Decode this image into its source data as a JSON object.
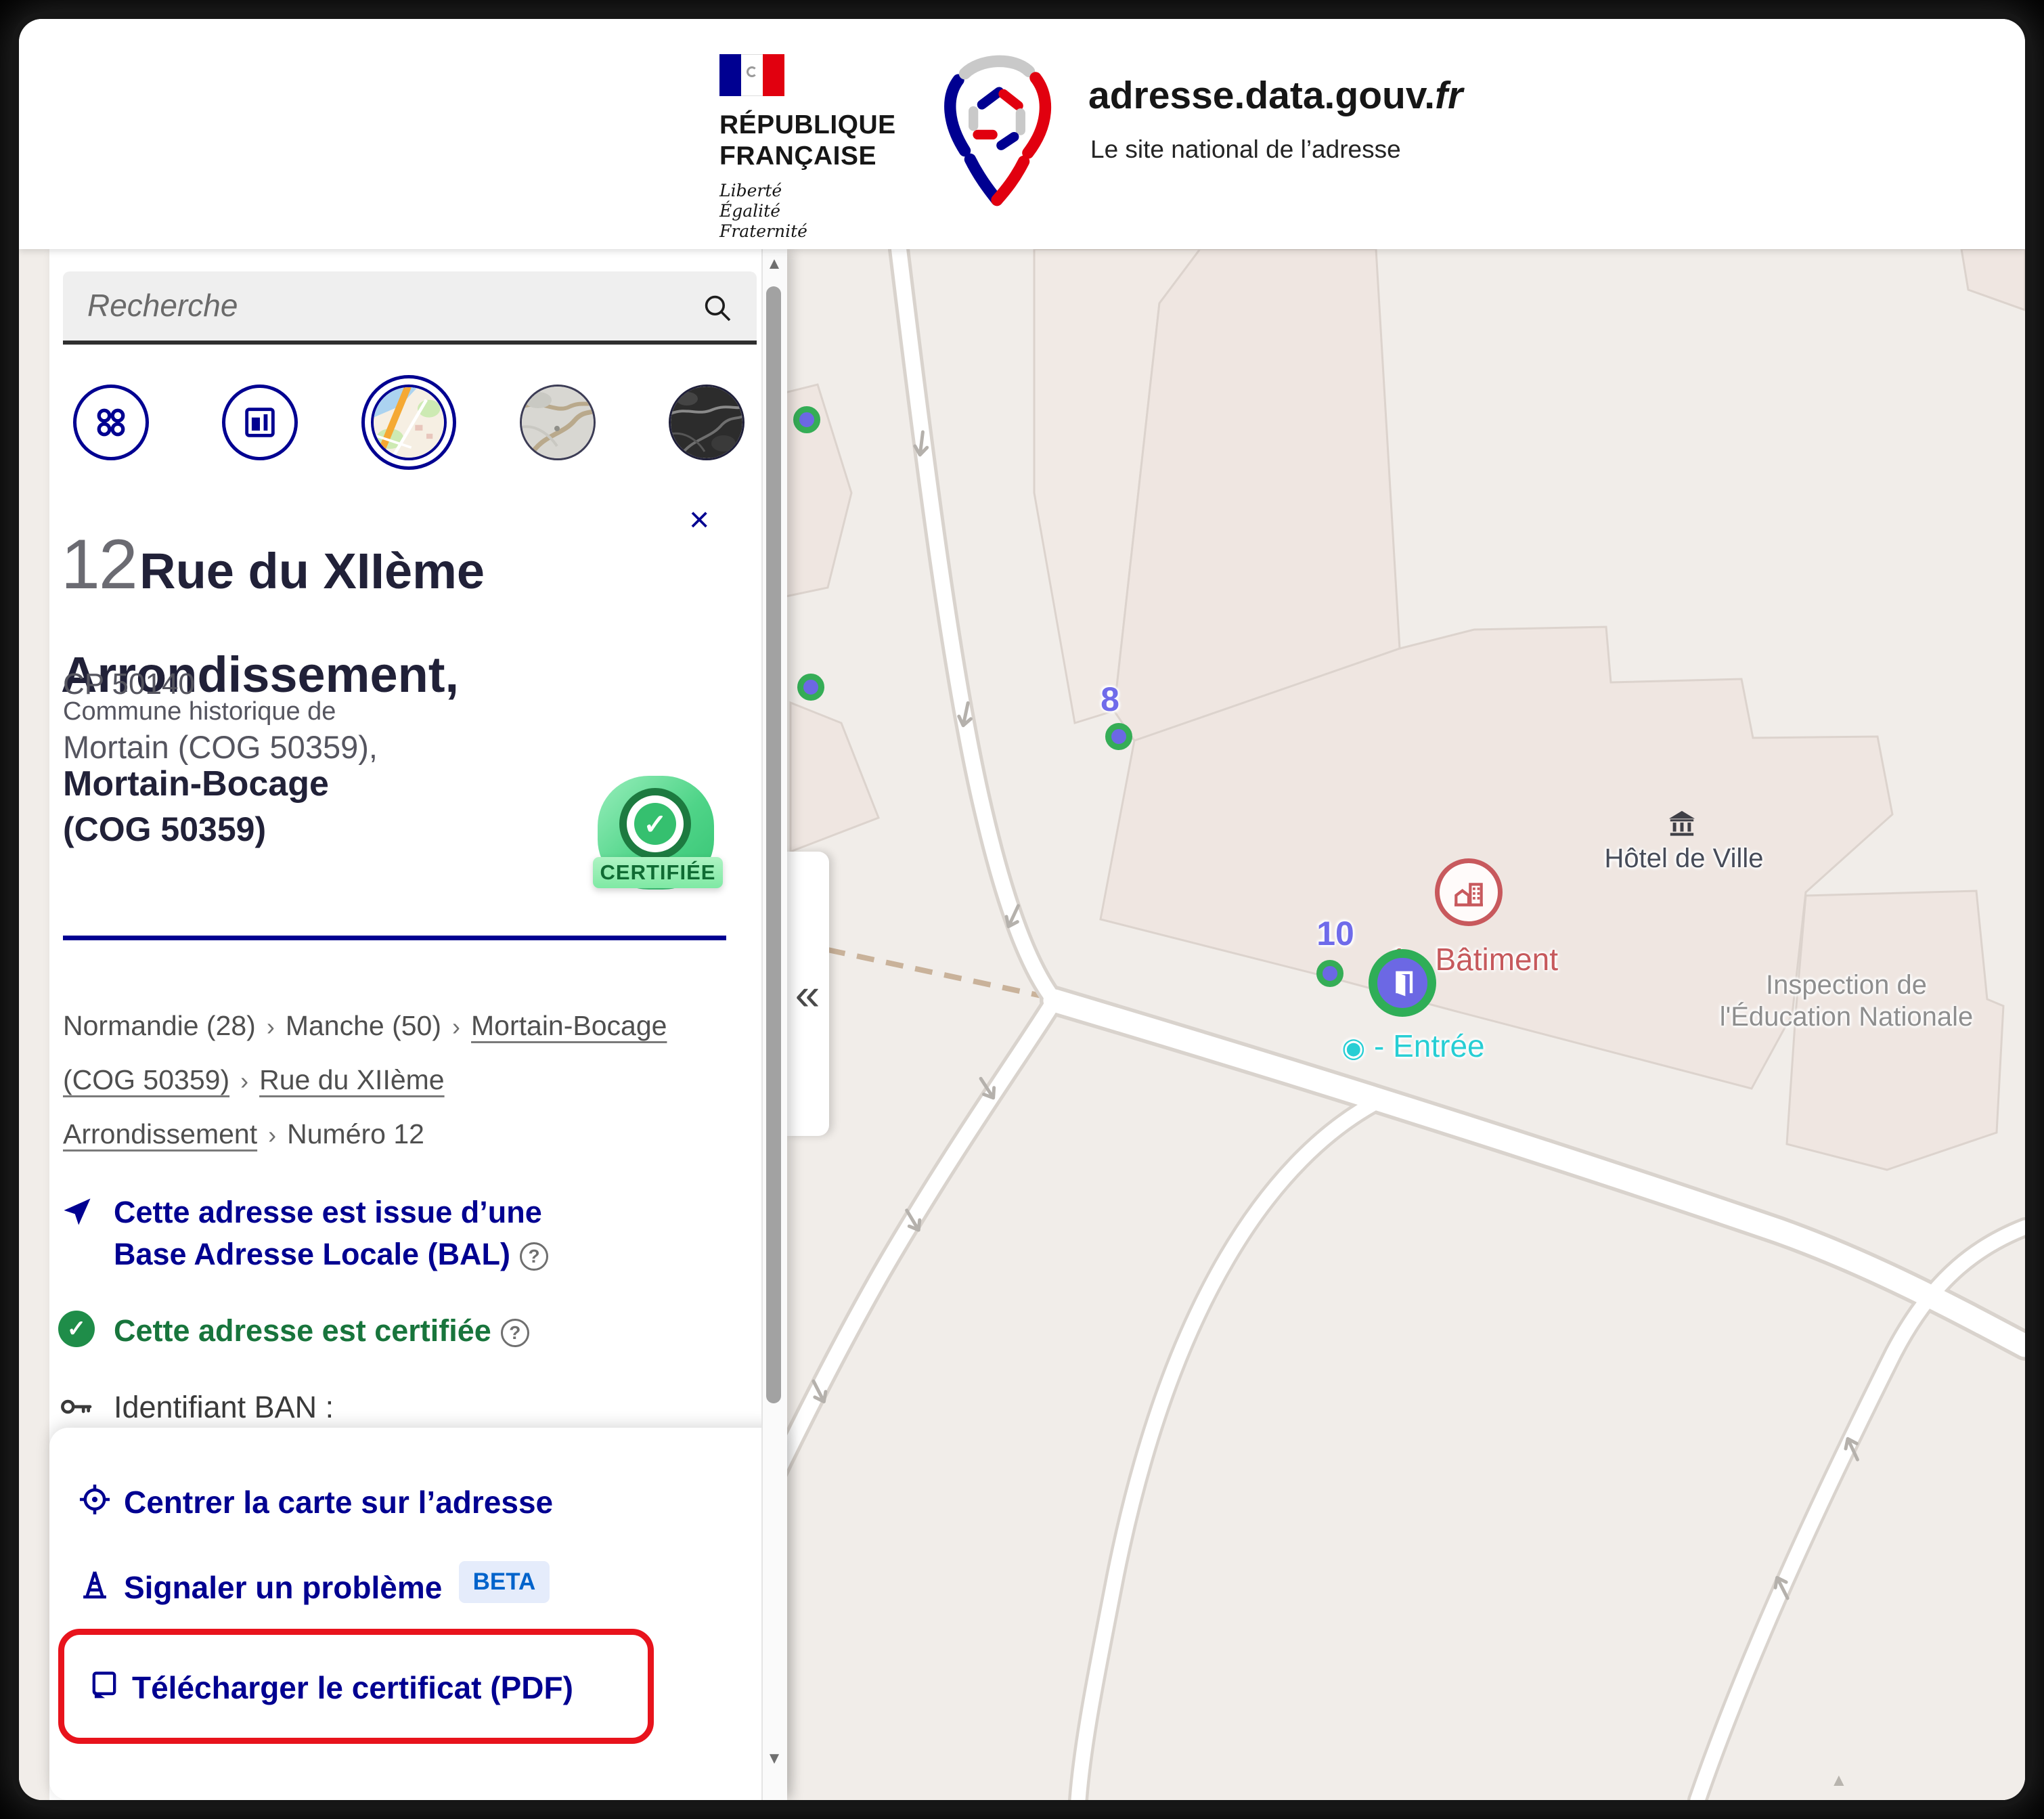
{
  "header": {
    "republique": {
      "line1": "RÉPUBLIQUE",
      "line2": "FRANÇAISE",
      "motto1": "Liberté",
      "motto2": "Égalité",
      "motto3": "Fraternité"
    },
    "site": {
      "title": "adresse.data.gouv.",
      "title_suffix": "fr",
      "subtitle": "Le site national de l’adresse"
    }
  },
  "sidebar": {
    "search": {
      "placeholder": "Recherche"
    },
    "close": "×",
    "collapse": "«",
    "address": {
      "number": "12",
      "street": "Rue du XIIème Arrondissement,",
      "postcode": "CP 50140",
      "historic_intro": "Commune historique de",
      "historic": "Mortain (COG 50359),",
      "commune": "Mortain-Bocage",
      "cog": "(COG 50359)",
      "badge": "CERTIFIÉE"
    },
    "breadcrumb": {
      "separator": "›",
      "items": [
        {
          "label": "Normandie (28)"
        },
        {
          "label": "Manche (50)"
        },
        {
          "label": "Mortain-Bocage (COG 50359)"
        },
        {
          "label": "Rue du XIIème Arrondissement"
        },
        {
          "label": "Numéro 12"
        }
      ]
    },
    "info": {
      "bal": "Cette adresse est issue d’une Base Adresse Locale (BAL)",
      "certified": "Cette adresse est certifiée",
      "ban": "Identifiant BAN :",
      "help": "?"
    },
    "actions": {
      "center": "Centrer la carte sur l’adresse",
      "report": "Signaler un problème",
      "report_badge": "BETA",
      "certificate": "Télécharger le certificat (PDF)"
    }
  },
  "map": {
    "markers": {
      "m8": "8",
      "m10": "10"
    },
    "building": "1 - Bâtiment",
    "entrance_bullet": "◉",
    "entrance": "- Entrée",
    "hotel_de_ville": "Hôtel de Ville",
    "inspection_line1": "Inspection de",
    "inspection_line2": "l'Éducation Nationale"
  },
  "icons": {
    "check": "✓",
    "scroll_up": "▲",
    "scroll_down": "▼",
    "map_triangle": "▲"
  },
  "colors": {
    "gov_blue": "#000091",
    "marianne_red": "#e1000f",
    "green": "#18753c",
    "purple": "#6c68e4",
    "marker_green": "#35ad56",
    "cyan": "#27ced4",
    "label_red": "#c6595c",
    "beta_blue": "#0063cb",
    "highlight_red": "#e8131c"
  }
}
